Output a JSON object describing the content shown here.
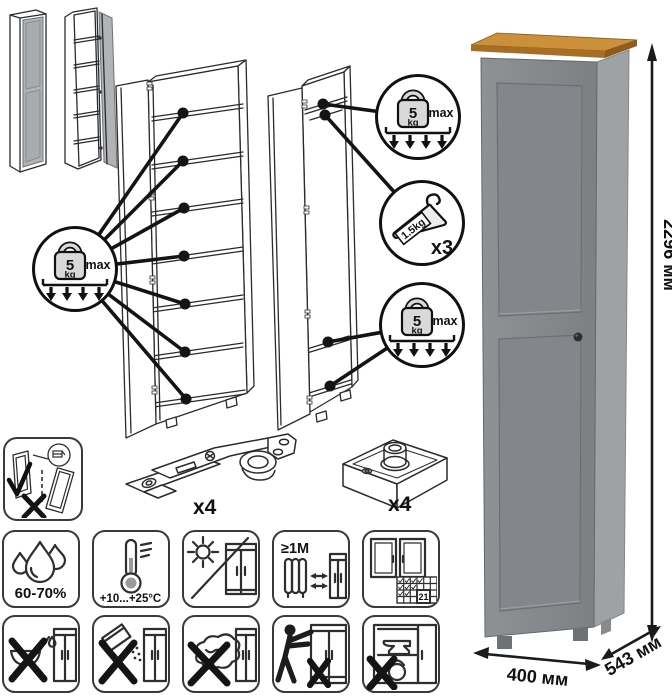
{
  "dimensions": {
    "height": "2296 мм",
    "width": "400 мм",
    "depth": "543 мм"
  },
  "load_badge": {
    "value": "5",
    "unit": "kg",
    "max_label": "max"
  },
  "hanger_badge": {
    "weight": "1.5kg",
    "count": "x3"
  },
  "hardware": {
    "hinge_count": "x4",
    "foot_count": "x4"
  },
  "care": {
    "humidity": "60-70%",
    "temperature": "+10...+25°C",
    "min_distance": "≥1M",
    "calendar_day": "21"
  }
}
